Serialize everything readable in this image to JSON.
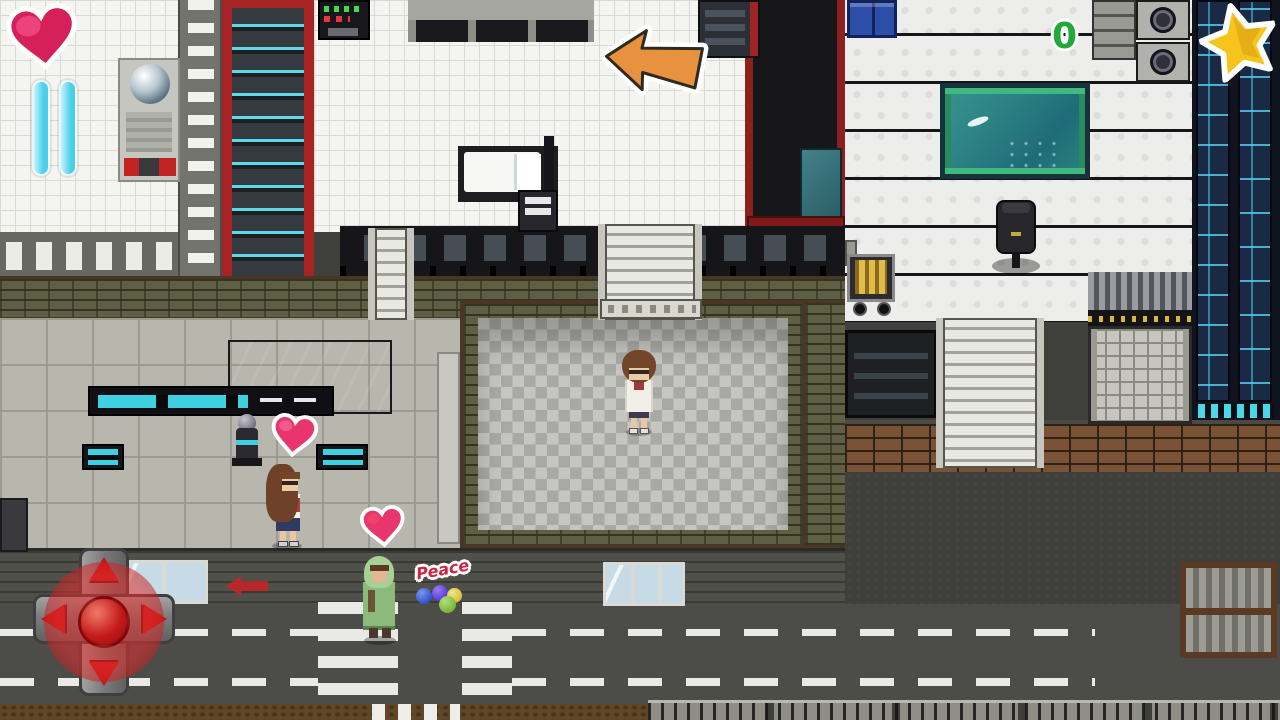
{
  "hud": {
    "health": {
      "icon": "heart-icon",
      "color": "#e8356d"
    },
    "pause_button": {
      "icon": "pause-icon",
      "color": "#56d4ec"
    },
    "star_badge": {
      "icon": "star-icon",
      "color": "#f6c41d"
    },
    "counter": {
      "value": "0",
      "color": "#23a83a"
    },
    "hint_arrow": {
      "icon": "arrow-left-icon",
      "color": "#e8913f"
    },
    "joystick": {
      "icon": "dpad-icon",
      "directions": [
        "up",
        "right",
        "down",
        "left"
      ],
      "base_color": "#8f8f8f",
      "arrow_color": "#c91414",
      "knob_color": "#c41a1a"
    }
  },
  "scene": {
    "peace_sign": {
      "text": "Peace",
      "text_color": "#cf2440",
      "balloon_colors": [
        "#3354c8",
        "#5a3ad8",
        "#d8c23a",
        "#78b53a"
      ]
    },
    "hearts": {
      "count": 2,
      "color": "#e8356d"
    },
    "characters": [
      {
        "id": "lab-coat-girl",
        "location": "checkered plaza"
      },
      {
        "id": "long-hair-girl",
        "location": "lobby"
      },
      {
        "id": "green-cloaked-figure",
        "location": "sidewalk"
      }
    ],
    "aquarium": {
      "water_color": "#2a7f83",
      "frame_color": "#3fb97e"
    },
    "road": {
      "asphalt_color": "#4c4c49",
      "marking_color": "#e9e9e6"
    }
  }
}
